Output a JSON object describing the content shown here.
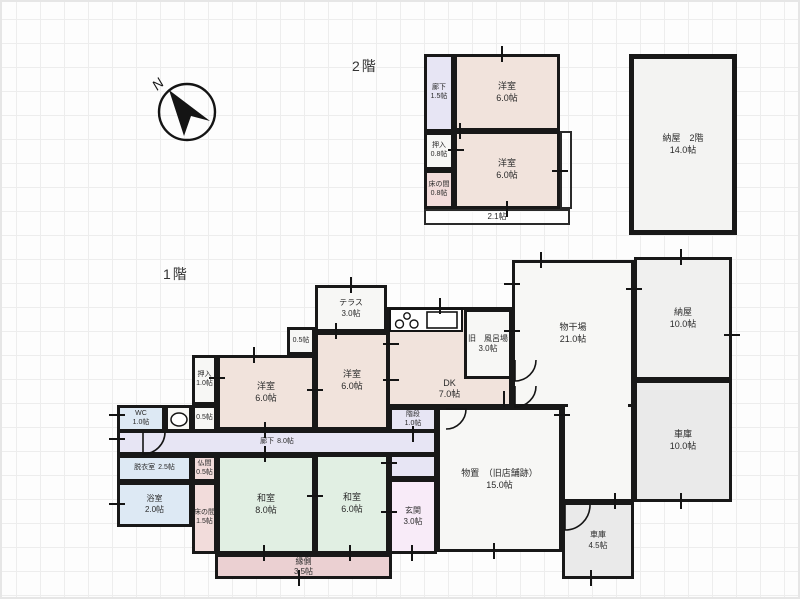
{
  "floors": {
    "f2": {
      "label": "2階"
    },
    "f1": {
      "label": "1階"
    }
  },
  "compass": {
    "north": "N"
  },
  "colors": {
    "wall": "#181818",
    "western_room": "#f1e3dc",
    "japanese_room": "#e1efe3",
    "hallway": "#e7e5f4",
    "tokonoma_pink": "#f2dcdb",
    "engawa_rose": "#ebd0d2",
    "entrance_pink": "#f8ebf8",
    "wet_area_blue": "#dde9f4",
    "storage_white": "#f7f7f5",
    "barn_gray": "#f0f0ef",
    "garage_gray": "#eaeaea",
    "grid_line": "#ededed"
  },
  "rooms": {
    "f2_rouka": {
      "name": "廊下",
      "size": "1.5帖"
    },
    "f2_oshiire": {
      "name": "押入",
      "size": "0.8帖"
    },
    "f2_tokonoma": {
      "name": "床の間",
      "size": "0.8帖"
    },
    "f2_yoshitsu_a": {
      "name": "洋室",
      "size": "6.0帖"
    },
    "f2_yoshitsu_b": {
      "name": "洋室",
      "size": "6.0帖"
    },
    "f2_balcony": {
      "size": "2.1帖"
    },
    "naya2f": {
      "name": "納屋　2階",
      "size": "14.0帖"
    },
    "terrace": {
      "name": "テラス",
      "size": "3.0帖"
    },
    "furoba": {
      "name": "旧　風呂場",
      "size": "3.0帖"
    },
    "dk": {
      "name": "DK",
      "size": "7.0帖"
    },
    "monohoshiba": {
      "name": "物干場",
      "size": "21.0帖"
    },
    "naya1f": {
      "name": "納屋",
      "size": "10.0帖"
    },
    "shako10": {
      "name": "車庫",
      "size": "10.0帖"
    },
    "closet_top": {
      "size": "0.5帖"
    },
    "yoshitsu_mid": {
      "name": "洋室",
      "size": "6.0帖"
    },
    "yoshitsu_left": {
      "name": "洋室",
      "size": "6.0帖"
    },
    "oshiire1f": {
      "name": "押入",
      "size": "1.0帖"
    },
    "wc": {
      "name": "WC",
      "size": "1.0帖"
    },
    "closet_mid": {
      "size": "0.5帖"
    },
    "kaidan": {
      "name": "階段",
      "size": "1.0帖"
    },
    "rouka1f": {
      "name": "廊下",
      "size": "8.0帖"
    },
    "datsui": {
      "name": "脱衣室",
      "size": "2.5帖"
    },
    "yokushitsu": {
      "name": "浴室",
      "size": "2.0帖"
    },
    "butsuma": {
      "name": "仏間",
      "size": "0.5帖"
    },
    "tokonoma1f": {
      "name": "床の間",
      "size": "1.5帖"
    },
    "washitsu8": {
      "name": "和室",
      "size": "8.0帖"
    },
    "washitsu6": {
      "name": "和室",
      "size": "6.0帖"
    },
    "genkan": {
      "name": "玄関",
      "size": "3.0帖"
    },
    "engawa": {
      "name": "縁側",
      "size": "3.5帖"
    },
    "monooki": {
      "name": "物置　（旧店舗跡）",
      "size": "15.0帖"
    },
    "shako45": {
      "name": "車庫",
      "size": "4.5帖"
    }
  }
}
